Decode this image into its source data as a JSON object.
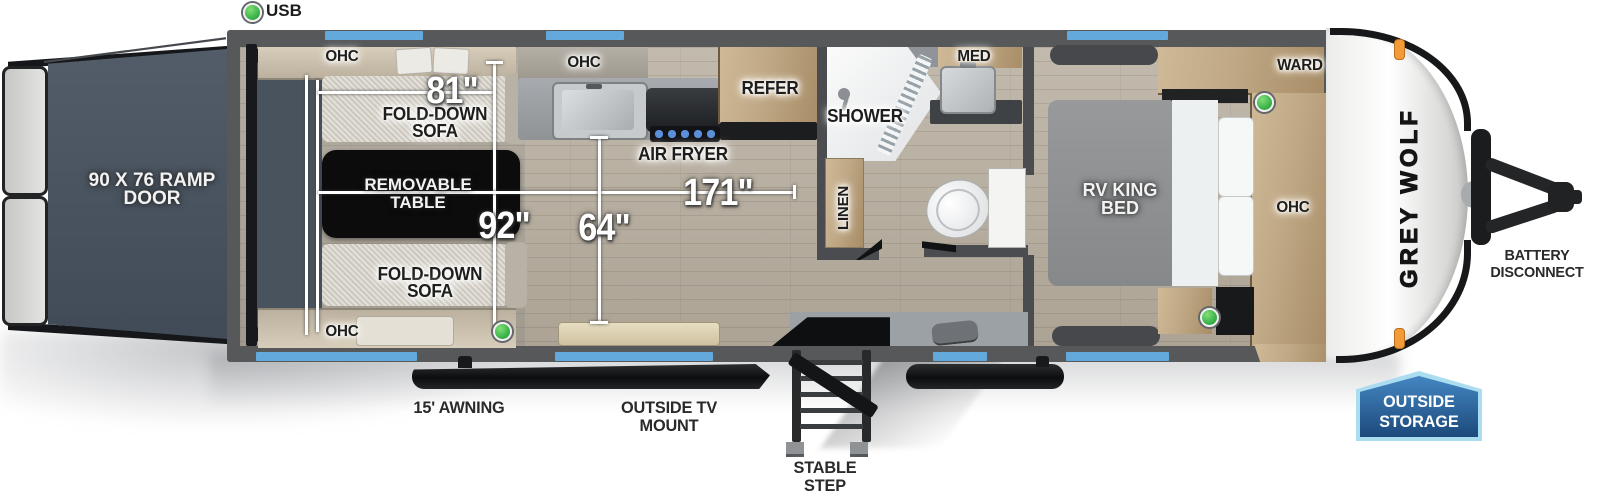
{
  "legend": {
    "usb": "USB"
  },
  "dimensions": {
    "sofa_width": "81\"",
    "garage_width": "92\"",
    "interior_length": "171\"",
    "kitchen_width": "64\""
  },
  "garage": {
    "ramp_door": "90 X 76 RAMP DOOR",
    "ohc_top": "OHC",
    "ohc_bottom": "OHC",
    "fold_down_sofa_top": "FOLD-DOWN SOFA",
    "fold_down_sofa_bottom": "FOLD-DOWN SOFA",
    "removable_table": "REMOVABLE TABLE"
  },
  "kitchen": {
    "ohc": "OHC",
    "air_fryer": "AIR FRYER",
    "refer": "REFER"
  },
  "bathroom": {
    "shower": "SHOWER",
    "med": "MED",
    "linen": "LINEN"
  },
  "bedroom": {
    "rv_king_bed": "RV KING BED",
    "ward": "WARD",
    "ohc": "OHC"
  },
  "exterior": {
    "brand": "GREY WOLF",
    "awning": "15' AWNING",
    "tv_mount": "OUTSIDE TV MOUNT",
    "stable_step": "STABLE STEP",
    "battery_disconnect": "BATTERY DISCONNECT",
    "outside_storage": "OUTSIDE STORAGE"
  },
  "colors": {
    "window_blue": "#64A9DC",
    "usb_green": "#3CB54A",
    "wall_gray": "#57585A",
    "ramp_door_slate": "#47515D",
    "storage_badge_blue": "#2E6DA8",
    "storage_badge_border": "#ABDDF1",
    "marker_orange": "#F29B38"
  }
}
